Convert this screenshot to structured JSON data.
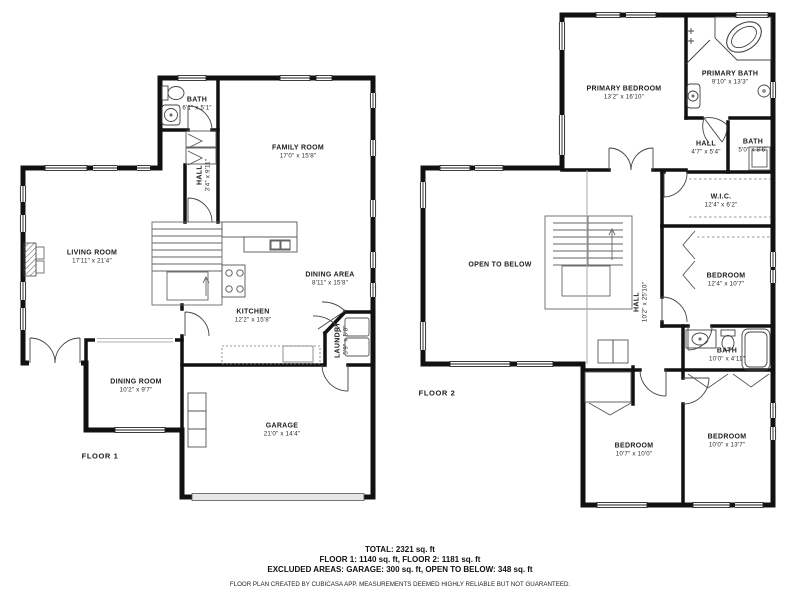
{
  "floor1": {
    "label": "FLOOR 1",
    "rooms": {
      "bath": {
        "name": "BATH",
        "dims": "6'1\" x 5'1\""
      },
      "hall": {
        "name": "HALL",
        "dims": "3'4\" x 9'11\""
      },
      "family_room": {
        "name": "FAMILY ROOM",
        "dims": "17'0\" x 15'8\""
      },
      "living_room": {
        "name": "LIVING ROOM",
        "dims": "17'11\" x 21'4\""
      },
      "dining_area": {
        "name": "DINING AREA",
        "dims": "8'11\" x 15'8\""
      },
      "kitchen": {
        "name": "KITCHEN",
        "dims": "12'2\" x 15'8\""
      },
      "laundry": {
        "name": "LAUNDRY",
        "dims": "5'9\" x 5'8\""
      },
      "dining_room": {
        "name": "DINING ROOM",
        "dims": "10'2\" x 9'7\""
      },
      "garage": {
        "name": "GARAGE",
        "dims": "21'0\" x 14'4\""
      }
    }
  },
  "floor2": {
    "label": "FLOOR 2",
    "rooms": {
      "primary_bedroom": {
        "name": "PRIMARY BEDROOM",
        "dims": "13'2\" x 16'10\""
      },
      "primary_bath": {
        "name": "PRIMARY BATH",
        "dims": "9'10\" x 13'3\""
      },
      "hall_upper": {
        "name": "HALL",
        "dims": "4'7\" x 5'4\""
      },
      "bath_upper": {
        "name": "BATH",
        "dims": "5'0\" x 8'6\""
      },
      "wic": {
        "name": "W.I.C.",
        "dims": "12'4\" x 6'2\""
      },
      "open_to_below": {
        "name": "OPEN TO BELOW"
      },
      "hall_main": {
        "name": "HALL",
        "dims": "10'2\" x 25'10\""
      },
      "bedroom_mid": {
        "name": "BEDROOM",
        "dims": "12'4\" x 10'7\""
      },
      "bath_mid": {
        "name": "BATH",
        "dims": "10'0\" x 4'11\""
      },
      "bedroom_bottom_left": {
        "name": "BEDROOM",
        "dims": "10'7\" x 10'0\""
      },
      "bedroom_bottom_right": {
        "name": "BEDROOM",
        "dims": "10'0\" x 13'7\""
      }
    }
  },
  "summary": {
    "total": "TOTAL: 2321 sq. ft",
    "floors": "FLOOR 1: 1140 sq. ft, FLOOR 2: 1181 sq. ft",
    "excluded": "EXCLUDED AREAS: GARAGE: 300 sq. ft, OPEN TO BELOW: 348 sq. ft",
    "disclaimer": "FLOOR PLAN CREATED BY CUBICASA APP. MEASUREMENTS DEEMED HIGHLY RELIABLE BUT NOT GUARANTEED."
  },
  "colors": {
    "wall": "#111111",
    "background": "#ffffff"
  }
}
